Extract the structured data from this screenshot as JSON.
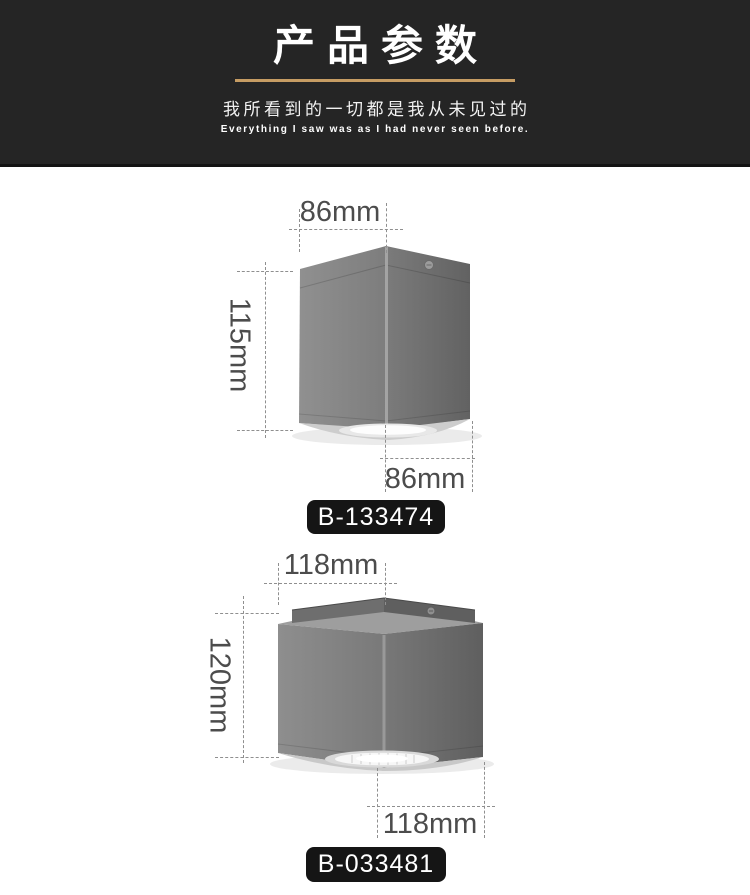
{
  "header": {
    "title": "产品参数",
    "subtitle_cn": "我所看到的一切都是我从未见过的",
    "subtitle_en": "Everything I saw was as I had never seen before.",
    "accent_color": "#C69C63",
    "background_color": "#252525"
  },
  "products": [
    {
      "model": "B-133474",
      "top_width": "86mm",
      "height": "115mm",
      "bottom_width": "86mm"
    },
    {
      "model": "B-033481",
      "top_width": "118mm",
      "height": "120mm",
      "bottom_width": "118mm"
    }
  ]
}
